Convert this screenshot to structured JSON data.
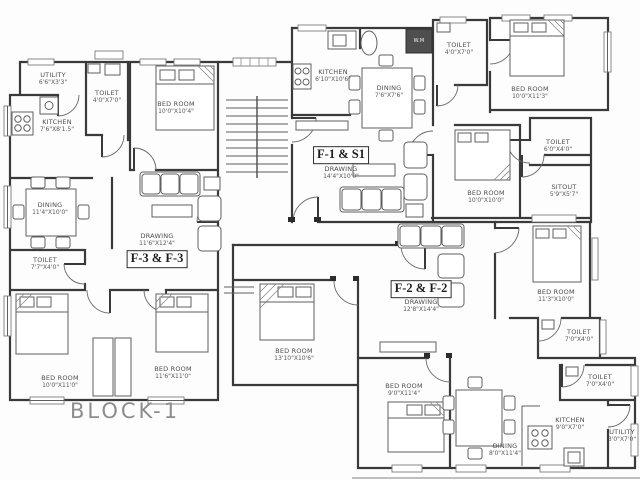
{
  "drawing": {
    "type": "residential floor plan",
    "block": {
      "label": "BLOCK-1"
    }
  },
  "colors": {
    "wall": "#3a3a3a",
    "furniture_line": "#5f5f5f",
    "label_text": "#4d4d4d",
    "block_text": "#8d8d8d",
    "paper": "#fdfdfd"
  },
  "units": [
    {
      "label": "F-1 & S1",
      "hall": "DRAWING",
      "hall_dims": "14'4\"X10'0\""
    },
    {
      "label": "F-3 & F-3",
      "hall": "DRAWING",
      "hall_dims": "11'6\"X12'4\""
    },
    {
      "label": "F-2 & F-2",
      "hall": "DRAWING",
      "hall_dims": "12'8\"X14'4\""
    }
  ],
  "rooms": [
    {
      "name": "UTILITY",
      "dims": "6'6\"X3'3\""
    },
    {
      "name": "TOILET",
      "dims": "4'0\"X7'0\""
    },
    {
      "name": "KITCHEN",
      "dims": "7'6\"X8'1.5\""
    },
    {
      "name": "BED ROOM",
      "dims": "10'0\"X10'4\""
    },
    {
      "name": "DINING",
      "dims": "11'4\"X10'0\""
    },
    {
      "name": "TOILET",
      "dims": "7'7\"X4'0\""
    },
    {
      "name": "BED ROOM",
      "dims": "10'0\"X11'0\""
    },
    {
      "name": "BED ROOM",
      "dims": "11'6\"X11'0\""
    },
    {
      "name": "KITCHEN",
      "dims": "6'10\"X10'6\""
    },
    {
      "name": "DINING",
      "dims": "7'6\"X7'6\""
    },
    {
      "name": "TOILET",
      "dims": "4'0\"X7'0\""
    },
    {
      "name": "BED ROOM",
      "dims": "10'0\"X11'3\""
    },
    {
      "name": "TOILET",
      "dims": "6'0\"X4'0\""
    },
    {
      "name": "BED ROOM",
      "dims": "10'0\"X10'0\""
    },
    {
      "name": "SITOUT",
      "dims": "5'9\"X5'7\""
    },
    {
      "name": "BED ROOM",
      "dims": "11'3\"X10'0\""
    },
    {
      "name": "BED ROOM",
      "dims": "13'10\"X10'6\""
    },
    {
      "name": "BED ROOM",
      "dims": "9'0\"X11'4\""
    },
    {
      "name": "TOILET",
      "dims": "7'0\"X4'0\""
    },
    {
      "name": "TOILET",
      "dims": "7'0\"X4'0\""
    },
    {
      "name": "KITCHEN",
      "dims": "9'0\"X7'0\""
    },
    {
      "name": "UTILITY",
      "dims": "3'0\"X7'0\""
    },
    {
      "name": "DINING",
      "dims": "8'0\"X11'4\""
    }
  ],
  "appliances": {
    "washing_machine": "W.M"
  }
}
